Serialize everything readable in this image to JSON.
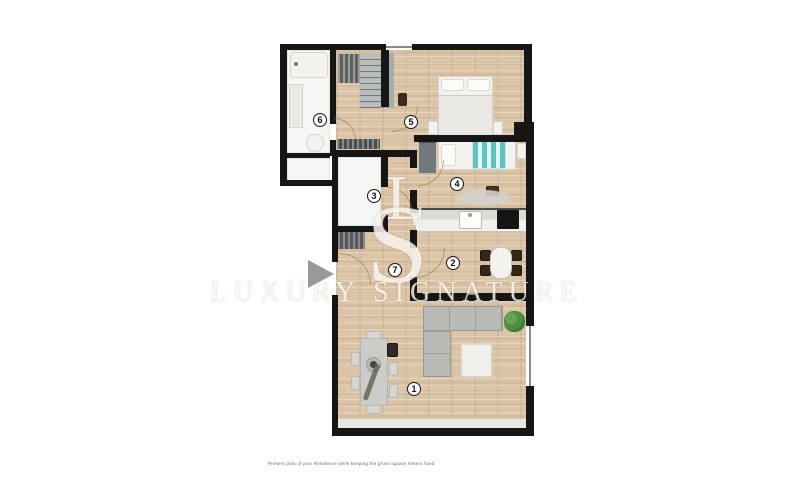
{
  "watermark": {
    "monogram": "LS",
    "brand": "LUXURY SIGNATURE"
  },
  "caption": "Present plan of your Residence while keeping the gross square meters fixed",
  "rooms": [
    {
      "number": "1"
    },
    {
      "number": "2"
    },
    {
      "number": "3"
    },
    {
      "number": "4"
    },
    {
      "number": "5"
    },
    {
      "number": "6"
    },
    {
      "number": "7"
    }
  ],
  "colors": {
    "wall": "#161616",
    "wood_floor": "#dbc5a6",
    "bath_floor": "#f5f5f3",
    "sofa": "#b7bab5",
    "accent_teal": "#57c7c0",
    "plant": "#4e8f3b",
    "play_button": "#909090",
    "watermark": "rgba(255,253,248,0.8)"
  }
}
